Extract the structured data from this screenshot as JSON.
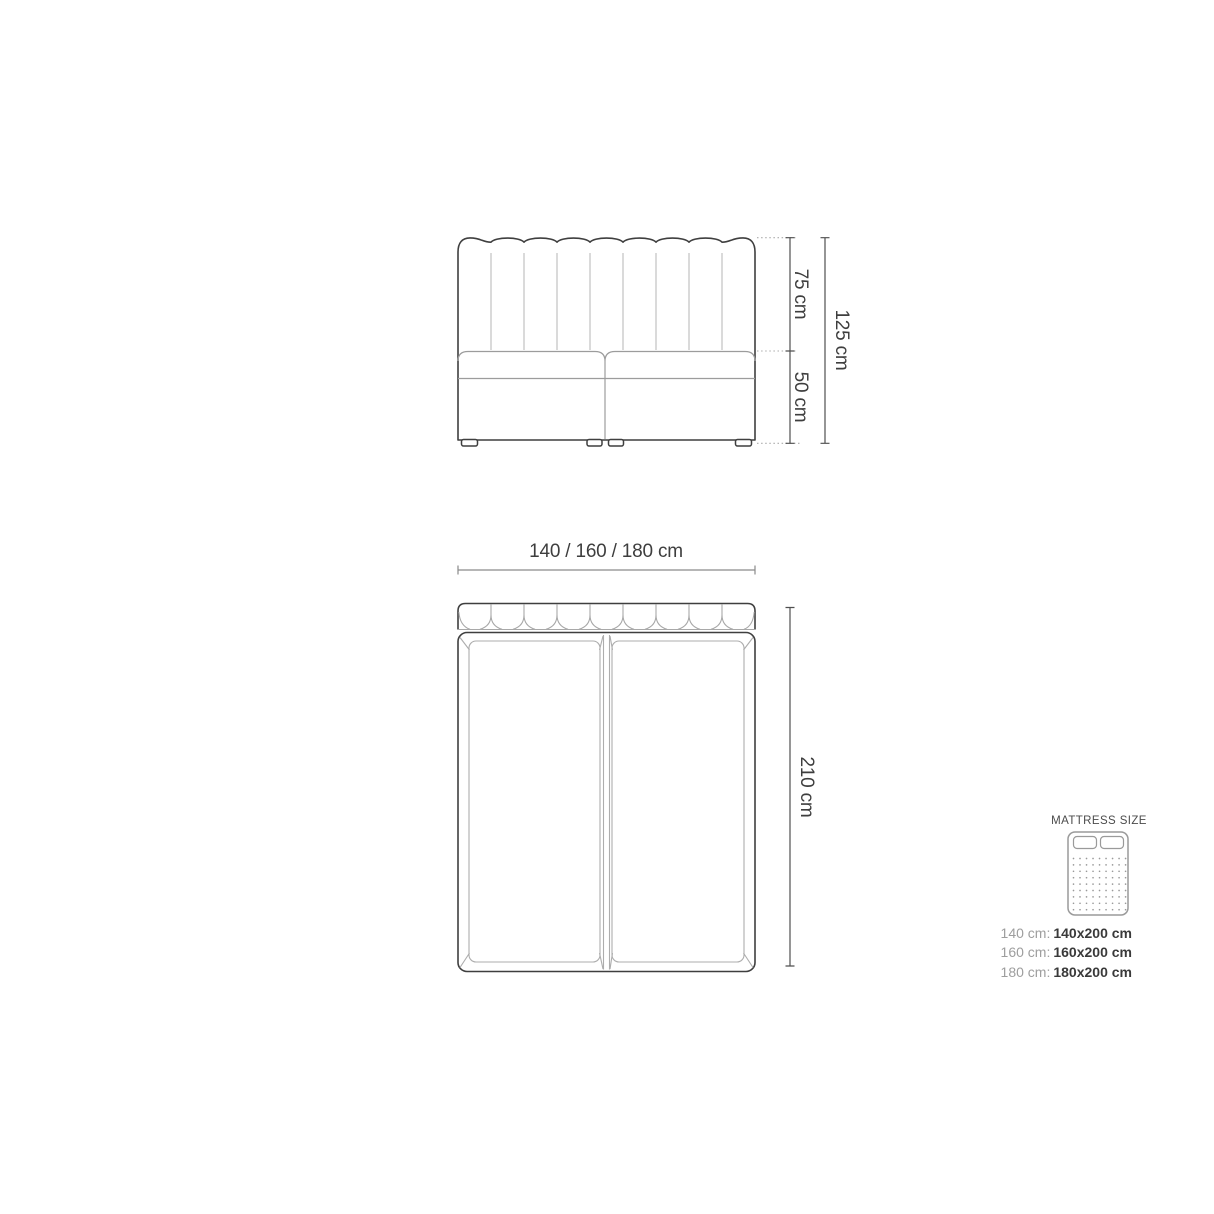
{
  "diagram_title": "bed-dimension-diagram",
  "front_view": {
    "headboard_height_label": "75 cm",
    "base_height_label": "50 cm",
    "total_height_label": "125 cm"
  },
  "top_view": {
    "width_label": "140 / 160 / 180 cm",
    "length_label": "210 cm"
  },
  "legend": {
    "title": "MATTRESS SIZE",
    "rows": [
      {
        "label": "140 cm:",
        "value": "140x200 cm"
      },
      {
        "label": "160 cm:",
        "value": "160x200 cm"
      },
      {
        "label": "180 cm:",
        "value": "180x200 cm"
      }
    ]
  },
  "dimensions_cm": {
    "headboard_height": 75,
    "base_height": 50,
    "total_height": 125,
    "widths": [
      140,
      160,
      180
    ],
    "length": 210,
    "mattress_sizes": [
      "140x200",
      "160x200",
      "180x200"
    ]
  },
  "colors": {
    "background": "#ffffff",
    "outline_dark": "#3f3f3f",
    "inner_line_light": "#c2c2c2",
    "inner_line_medium": "#9c9c9c",
    "dimension_line": "#4f4f4f",
    "width_dimension_line": "#8a8a8a",
    "dotted_leader": "#ababab",
    "text_dark": "#3e3e3e",
    "text_gray": "#9e9e9e",
    "legend_icon": "#9a9a9a"
  }
}
